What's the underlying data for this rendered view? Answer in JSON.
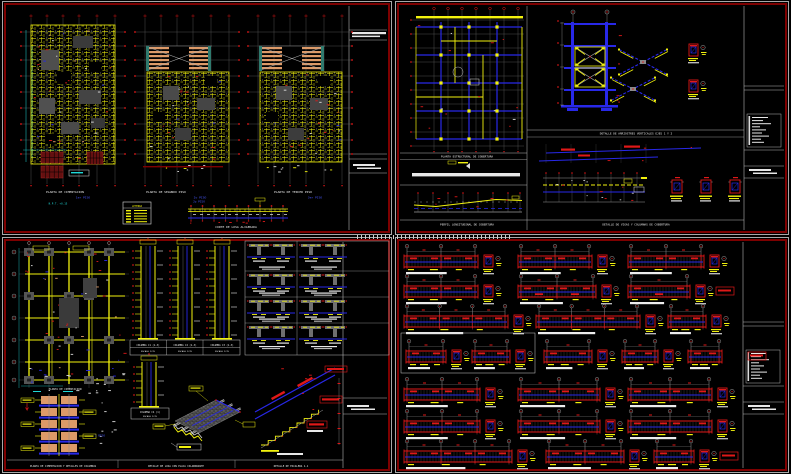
{
  "palette": {
    "background": "#000000",
    "sheet_border_outer": "#a8a8a8",
    "sheet_border_inner": "#7e0000",
    "yellow": "#f2f20e",
    "red": "#e01818",
    "dark_red": "#641010",
    "blue": "#2828e8",
    "cyan": "#1fd8d8",
    "salmon": "#dd9a68",
    "teal": "#2f7a6e",
    "white": "#e8e8e8",
    "gray": "#6f6f6f"
  },
  "sheets": {
    "tl": {
      "plans": [
        {
          "title": "PLANTA DE CIMENTACION",
          "level": "1er PISO"
        },
        {
          "title": "PLANTA DE SEGUNDO PISO",
          "level": "2o PISO"
        },
        {
          "title": "PLANTA DE TERCER PISO",
          "level": "3er PISO"
        }
      ],
      "note": "N.P.T. +0.15",
      "legend_title": "LEYENDA",
      "section_level": "2o PISO",
      "section_title": "CORTE DE LOSA ALIGERADA"
    },
    "tr": {
      "plan_title": "PLANTA ESTRUCTURAL DE COBERTURA",
      "brace_title": "DETALLE DE ARRIOSTRES VERTICALES EJES 1 Y 2",
      "profile_title": "PERFIL LONGITUDINAL DE COBERTURA",
      "beams_title": "DETALLE DE VIGAS Y COLUMNAS DE COBERTURA"
    },
    "bl": {
      "plan_title": "PLANTA DE CIMENTACION",
      "columns": [
        {
          "name": "COLUMNA C1 (1-3)",
          "scale": "ESCALA 1/25"
        },
        {
          "name": "COLUMNA C2 (1-3)",
          "scale": "ESCALA 1/25"
        },
        {
          "name": "COLUMNA C3 (1-3)",
          "scale": "ESCALA 1/25"
        }
      ],
      "column4": {
        "name": "COLUMNA C4 (1)",
        "scale": "ESCALA 1/25"
      },
      "level_label": "1 PISO",
      "footers": [
        "PLANTA DE CIMENTACION Y DETALLES DE COLUMNAS",
        "DETALLE DE LOSA CON PLACA COLABORANTE",
        "DETALLE DE ESCALERA 1-1"
      ]
    }
  }
}
